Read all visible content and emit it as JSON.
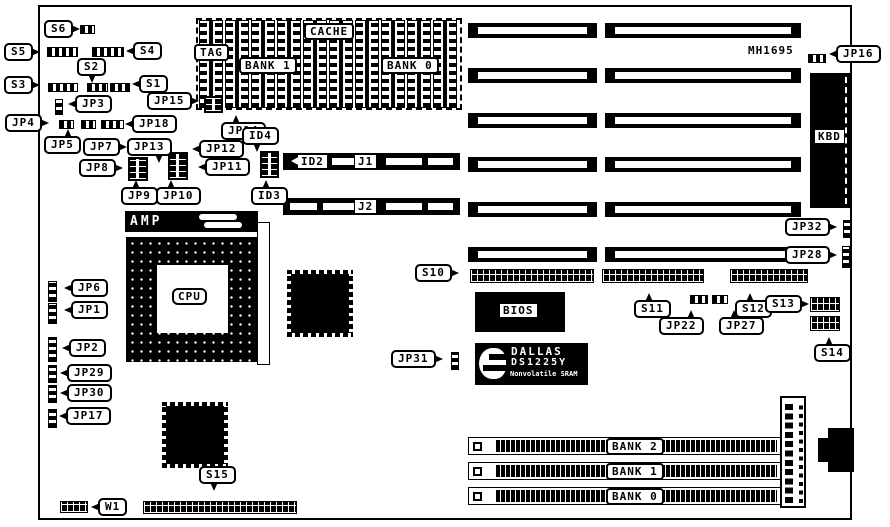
{
  "board": {
    "model": "MH1695"
  },
  "labels": {
    "cache": "CACHE",
    "tag": "TAG",
    "cache_bank1": "BANK 1",
    "cache_bank0": "BANK 0",
    "cpu": "CPU",
    "amp": "AMP",
    "kbd": "KBD",
    "bios": "BIOS",
    "j1": "J1",
    "j2": "J2",
    "id2": "ID2",
    "simm_bank2": "BANK 2",
    "simm_bank1": "BANK 1",
    "simm_bank0": "BANK 0",
    "dallas_line1": "DALLAS",
    "dallas_line2": "DS1225Y",
    "dallas_line3": "Nonvolatile SRAM"
  },
  "callouts": {
    "s1": "S1",
    "s2": "S2",
    "s3": "S3",
    "s4": "S4",
    "s5": "S5",
    "s6": "S6",
    "s10": "S10",
    "s11": "S11",
    "s12": "S12",
    "s13": "S13",
    "s14": "S14",
    "s15": "S15",
    "jp1": "JP1",
    "jp2": "JP2",
    "jp3": "JP3",
    "jp4": "JP4",
    "jp5": "JP5",
    "jp6": "JP6",
    "jp7": "JP7",
    "jp8": "JP8",
    "jp9": "JP9",
    "jp10": "JP10",
    "jp11": "JP11",
    "jp12": "JP12",
    "jp13": "JP13",
    "jp14": "JP14",
    "jp15": "JP15",
    "jp16": "JP16",
    "jp17": "JP17",
    "jp18": "JP18",
    "jp22": "JP22",
    "jp27": "JP27",
    "jp28": "JP28",
    "jp29": "JP29",
    "jp30": "JP30",
    "jp31": "JP31",
    "jp32": "JP32",
    "id2": "ID2",
    "id3": "ID3",
    "id4": "ID4",
    "w1": "W1"
  }
}
